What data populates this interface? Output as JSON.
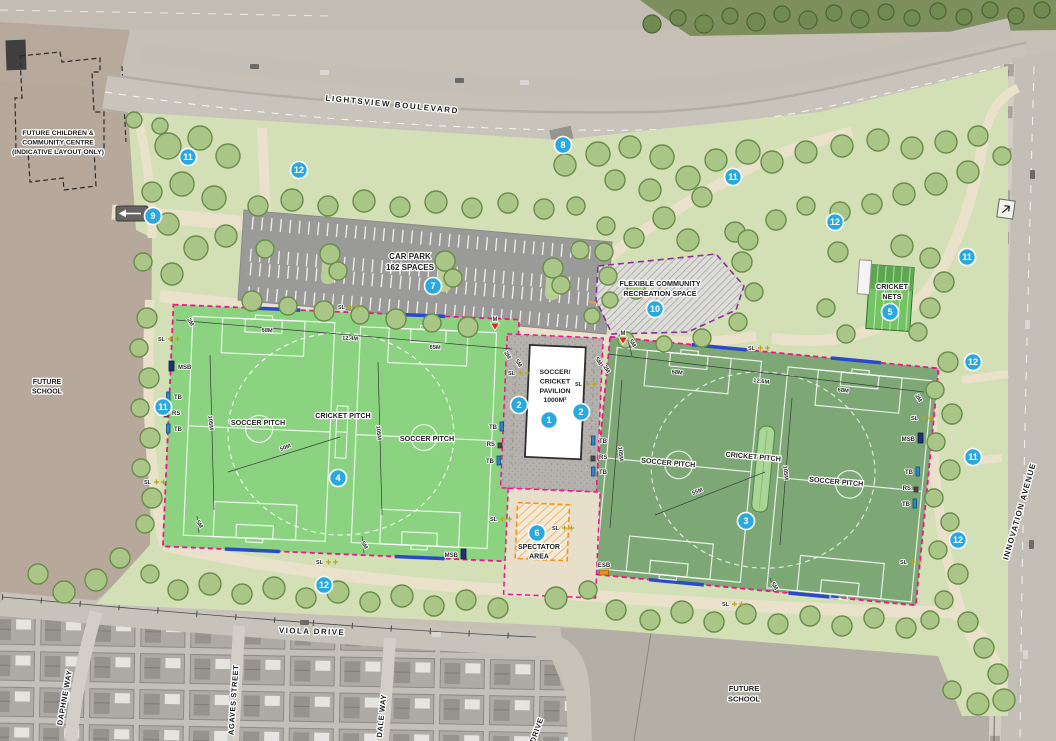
{
  "road_labels": [
    {
      "id": "lightsview-boulevard",
      "text": "LIGHTSVIEW BOULEVARD",
      "x": 392,
      "y": 107,
      "rot": 5.5,
      "size": 8,
      "ls": 1.6
    },
    {
      "id": "viola-drive",
      "text": "VIOLA DRIVE",
      "x": 312,
      "y": 634,
      "rot": 2,
      "size": 8,
      "ls": 1.4
    },
    {
      "id": "innovation-avenue",
      "text": "INNOVATION AVENUE",
      "x": 1022,
      "y": 512,
      "rot": -74,
      "size": 8,
      "ls": 1
    },
    {
      "id": "daphne-way",
      "text": "DAPHNE WAY",
      "x": 67,
      "y": 698,
      "rot": -80,
      "size": 7.5,
      "ls": 0.6
    },
    {
      "id": "agaves-street",
      "text": "AGAVES STREET",
      "x": 236,
      "y": 700,
      "rot": -86,
      "size": 7.5,
      "ls": 0.6
    },
    {
      "id": "dale-way",
      "text": "DALE WAY",
      "x": 384,
      "y": 716,
      "rot": -84,
      "size": 7.5,
      "ls": 0.6
    },
    {
      "id": "drive",
      "text": "DRIVE",
      "x": 539,
      "y": 731,
      "rot": -70,
      "size": 7.5,
      "ls": 0.6
    }
  ],
  "area_labels": [
    {
      "id": "future-children-community-centre",
      "lines": [
        "FUTURE CHILDREN &",
        "COMMUNITY CENTRE",
        "(INDICATIVE LAYOUT ONLY)"
      ],
      "x": 58,
      "y": 135,
      "size": 6.8
    },
    {
      "id": "future-school-west",
      "lines": [
        "FUTURE",
        "SCHOOL"
      ],
      "x": 47,
      "y": 384,
      "size": 7
    },
    {
      "id": "future-school-south",
      "lines": [
        "FUTURE",
        "SCHOOL"
      ],
      "x": 744,
      "y": 691,
      "size": 7.5
    },
    {
      "id": "car-park",
      "lines": [
        "CAR PARK",
        "162 SPACES"
      ],
      "x": 410,
      "y": 259,
      "size": 8
    },
    {
      "id": "flexible-community-recreation-space",
      "lines": [
        "FLEXIBLE COMMUNITY",
        "RECREATION SPACE"
      ],
      "x": 660,
      "y": 286,
      "size": 7.2
    },
    {
      "id": "cricket-nets",
      "lines": [
        "CRICKET",
        "NETS"
      ],
      "x": 892,
      "y": 289,
      "size": 7.2
    },
    {
      "id": "soccer-pitch-west-1",
      "lines": [
        "SOCCER PITCH"
      ],
      "x": 258,
      "y": 425,
      "size": 7.2
    },
    {
      "id": "cricket-pitch-west",
      "lines": [
        "CRICKET PITCH"
      ],
      "x": 343,
      "y": 418,
      "size": 7.2
    },
    {
      "id": "soccer-pitch-west-2",
      "lines": [
        "SOCCER PITCH"
      ],
      "x": 427,
      "y": 441,
      "size": 7.2
    },
    {
      "id": "soccer-pitch-east-1",
      "lines": [
        "SOCCER PITCH"
      ],
      "x": 668,
      "y": 465,
      "size": 7.2,
      "rot": 5
    },
    {
      "id": "cricket-pitch-east",
      "lines": [
        "CRICKET PITCH"
      ],
      "x": 753,
      "y": 459,
      "size": 7.2,
      "rot": 5
    },
    {
      "id": "soccer-pitch-east-2",
      "lines": [
        "SOCCER PITCH"
      ],
      "x": 836,
      "y": 484,
      "size": 7.2,
      "rot": 5
    },
    {
      "id": "pavilion",
      "lines": [
        "SOCCER/",
        "CRICKET",
        "PAVILION",
        "1000M²"
      ],
      "x": 555,
      "y": 374,
      "size": 6.8
    },
    {
      "id": "spectator-area",
      "lines": [
        "SPECTATOR",
        "AREA"
      ],
      "x": 539,
      "y": 549,
      "size": 7
    }
  ],
  "markers": [
    {
      "n": "1",
      "x": 549,
      "y": 420
    },
    {
      "n": "2",
      "x": 519,
      "y": 405
    },
    {
      "n": "2",
      "x": 581,
      "y": 412
    },
    {
      "n": "3",
      "x": 746,
      "y": 521
    },
    {
      "n": "4",
      "x": 338,
      "y": 478
    },
    {
      "n": "5",
      "x": 890,
      "y": 312
    },
    {
      "n": "6",
      "x": 537,
      "y": 533
    },
    {
      "n": "7",
      "x": 433,
      "y": 286
    },
    {
      "n": "8",
      "x": 563,
      "y": 145
    },
    {
      "n": "9",
      "x": 153,
      "y": 216
    },
    {
      "n": "10",
      "x": 655,
      "y": 309
    },
    {
      "n": "11",
      "x": 188,
      "y": 157
    },
    {
      "n": "11",
      "x": 733,
      "y": 177
    },
    {
      "n": "11",
      "x": 967,
      "y": 257
    },
    {
      "n": "11",
      "x": 163,
      "y": 407
    },
    {
      "n": "11",
      "x": 973,
      "y": 457
    },
    {
      "n": "12",
      "x": 299,
      "y": 170
    },
    {
      "n": "12",
      "x": 835,
      "y": 222
    },
    {
      "n": "12",
      "x": 973,
      "y": 362
    },
    {
      "n": "12",
      "x": 958,
      "y": 540
    },
    {
      "n": "12",
      "x": 324,
      "y": 585
    }
  ],
  "dimensions": [
    {
      "text": "2M",
      "x": 189,
      "y": 323,
      "rot": 60
    },
    {
      "text": "68M",
      "x": 267,
      "y": 332,
      "rot": 4
    },
    {
      "text": "12.4M",
      "x": 350,
      "y": 340,
      "rot": 4
    },
    {
      "text": "65M",
      "x": 435,
      "y": 349,
      "rot": 4
    },
    {
      "text": "2M",
      "x": 506,
      "y": 356,
      "rot": 60
    },
    {
      "text": "105M",
      "x": 209,
      "y": 423,
      "rot": 85
    },
    {
      "text": "105M",
      "x": 377,
      "y": 433,
      "rot": 85
    },
    {
      "text": "50M",
      "x": 286,
      "y": 449,
      "rot": -22
    },
    {
      "text": "5M",
      "x": 198,
      "y": 525,
      "rot": 60
    },
    {
      "text": "5M",
      "x": 363,
      "y": 546,
      "rot": 60
    },
    {
      "text": "5M",
      "x": 517,
      "y": 364,
      "rot": 60
    },
    {
      "text": "5M",
      "x": 597,
      "y": 362,
      "rot": 60
    },
    {
      "text": "5M",
      "x": 631,
      "y": 344,
      "rot": 60
    },
    {
      "text": "2M",
      "x": 605,
      "y": 370,
      "rot": 60
    },
    {
      "text": "68M",
      "x": 677,
      "y": 374,
      "rot": 7
    },
    {
      "text": "12.6M",
      "x": 761,
      "y": 383,
      "rot": 7
    },
    {
      "text": "68M",
      "x": 843,
      "y": 392,
      "rot": 7
    },
    {
      "text": "2M",
      "x": 917,
      "y": 399,
      "rot": 60
    },
    {
      "text": "105M",
      "x": 619,
      "y": 454,
      "rot": 85
    },
    {
      "text": "105M",
      "x": 784,
      "y": 473,
      "rot": 85
    },
    {
      "text": "55M",
      "x": 698,
      "y": 493,
      "rot": -22
    },
    {
      "text": "5M",
      "x": 773,
      "y": 587,
      "rot": 60
    }
  ],
  "equipment": [
    {
      "t": "MSB",
      "x": 178,
      "y": 369,
      "s": "il"
    },
    {
      "t": "TB",
      "x": 174,
      "y": 399,
      "s": "il"
    },
    {
      "t": "RS",
      "x": 172,
      "y": 415,
      "s": "il"
    },
    {
      "t": "TB",
      "x": 174,
      "y": 431,
      "s": "il"
    },
    {
      "t": "TB",
      "x": 497,
      "y": 429,
      "s": "ir"
    },
    {
      "t": "RS",
      "x": 495,
      "y": 446,
      "s": "ir"
    },
    {
      "t": "TB",
      "x": 494,
      "y": 463,
      "s": "ir"
    },
    {
      "t": "TB",
      "x": 599,
      "y": 443,
      "s": "il"
    },
    {
      "t": "RS",
      "x": 599,
      "y": 459,
      "s": "il"
    },
    {
      "t": "TB",
      "x": 599,
      "y": 474,
      "s": "il"
    },
    {
      "t": "MSB",
      "x": 915,
      "y": 441,
      "s": "ir"
    },
    {
      "t": "TB",
      "x": 913,
      "y": 474,
      "s": "ir"
    },
    {
      "t": "RS",
      "x": 911,
      "y": 490,
      "s": "ir"
    },
    {
      "t": "TB",
      "x": 910,
      "y": 506,
      "s": "ir"
    },
    {
      "t": "MSB",
      "x": 458,
      "y": 557,
      "s": "ir"
    },
    {
      "t": "ESB",
      "x": 604,
      "y": 567,
      "s": "ib"
    }
  ],
  "light_label": "SL",
  "lights": [
    [
      352,
      307
    ],
    [
      172,
      339
    ],
    [
      158,
      482
    ],
    [
      330,
      562
    ],
    [
      504,
      519
    ],
    [
      566,
      528
    ],
    [
      736,
      604
    ],
    [
      914,
      562
    ],
    [
      762,
      348
    ],
    [
      522,
      373
    ],
    [
      589,
      384
    ],
    [
      925,
      418
    ]
  ],
  "monument_label": "M",
  "monuments": [
    {
      "x": 495,
      "y": 321
    },
    {
      "x": 623,
      "y": 335
    }
  ],
  "colors": {
    "marker_blue": "#2aa9e1",
    "boundary_pink": "#f0148c",
    "boundary_blue": "#2b49cc",
    "flexible_purple": "#8c2f96",
    "spectator_orange": "#f6921e",
    "field_west_green": "#8bd381",
    "field_east_green": "#7da875",
    "park_green": "#d3e0b6"
  },
  "decor": {
    "trees": [
      [
        168,
        146,
        13
      ],
      [
        200,
        138,
        12
      ],
      [
        228,
        156,
        12
      ],
      [
        182,
        184,
        12
      ],
      [
        214,
        198,
        12
      ],
      [
        168,
        224,
        11
      ],
      [
        196,
        248,
        12
      ],
      [
        172,
        274,
        11
      ],
      [
        226,
        236,
        11
      ],
      [
        152,
        192,
        10
      ],
      [
        143,
        262,
        9
      ],
      [
        258,
        206,
        10
      ],
      [
        292,
        200,
        11
      ],
      [
        328,
        206,
        10
      ],
      [
        364,
        201,
        11
      ],
      [
        400,
        207,
        10
      ],
      [
        436,
        202,
        11
      ],
      [
        472,
        208,
        10
      ],
      [
        508,
        203,
        10
      ],
      [
        544,
        209,
        10
      ],
      [
        576,
        206,
        9
      ],
      [
        265,
        249,
        9
      ],
      [
        330,
        254,
        10
      ],
      [
        338,
        271,
        9
      ],
      [
        445,
        261,
        10
      ],
      [
        453,
        278,
        9
      ],
      [
        553,
        268,
        10
      ],
      [
        561,
        285,
        9
      ],
      [
        608,
        276,
        9
      ],
      [
        252,
        301,
        10
      ],
      [
        288,
        306,
        9
      ],
      [
        324,
        311,
        10
      ],
      [
        360,
        315,
        9
      ],
      [
        396,
        319,
        10
      ],
      [
        432,
        323,
        9
      ],
      [
        468,
        327,
        10
      ],
      [
        147,
        318,
        10
      ],
      [
        139,
        348,
        9
      ],
      [
        149,
        378,
        10
      ],
      [
        140,
        408,
        9
      ],
      [
        150,
        438,
        10
      ],
      [
        141,
        468,
        9
      ],
      [
        152,
        498,
        10
      ],
      [
        145,
        524,
        9
      ],
      [
        565,
        165,
        11
      ],
      [
        598,
        154,
        12
      ],
      [
        630,
        147,
        11
      ],
      [
        662,
        157,
        12
      ],
      [
        615,
        180,
        10
      ],
      [
        650,
        190,
        11
      ],
      [
        688,
        178,
        12
      ],
      [
        716,
        160,
        11
      ],
      [
        748,
        152,
        12
      ],
      [
        702,
        197,
        10
      ],
      [
        664,
        218,
        11
      ],
      [
        634,
        238,
        10
      ],
      [
        688,
        240,
        11
      ],
      [
        580,
        250,
        9
      ],
      [
        606,
        226,
        9
      ],
      [
        735,
        232,
        10
      ],
      [
        772,
        162,
        11
      ],
      [
        806,
        152,
        11
      ],
      [
        842,
        146,
        11
      ],
      [
        878,
        140,
        11
      ],
      [
        912,
        148,
        11
      ],
      [
        946,
        142,
        11
      ],
      [
        978,
        136,
        10
      ],
      [
        1002,
        156,
        9
      ],
      [
        968,
        172,
        11
      ],
      [
        936,
        184,
        11
      ],
      [
        904,
        194,
        11
      ],
      [
        872,
        204,
        10
      ],
      [
        840,
        212,
        10
      ],
      [
        806,
        206,
        9
      ],
      [
        776,
        220,
        10
      ],
      [
        748,
        240,
        10
      ],
      [
        636,
        290,
        9
      ],
      [
        610,
        300,
        8
      ],
      [
        838,
        252,
        10
      ],
      [
        902,
        246,
        11
      ],
      [
        930,
        258,
        10
      ],
      [
        944,
        282,
        10
      ],
      [
        930,
        308,
        10
      ],
      [
        918,
        332,
        9
      ],
      [
        846,
        334,
        9
      ],
      [
        826,
        308,
        9
      ],
      [
        948,
        362,
        10
      ],
      [
        935,
        390,
        9
      ],
      [
        952,
        414,
        10
      ],
      [
        936,
        442,
        9
      ],
      [
        950,
        470,
        10
      ],
      [
        934,
        498,
        9
      ],
      [
        950,
        522,
        9
      ],
      [
        938,
        550,
        9
      ],
      [
        958,
        574,
        10
      ],
      [
        944,
        600,
        9
      ],
      [
        968,
        622,
        10
      ],
      [
        984,
        648,
        10
      ],
      [
        998,
        674,
        10
      ],
      [
        1004,
        700,
        11
      ],
      [
        978,
        704,
        11
      ],
      [
        952,
        690,
        9
      ],
      [
        120,
        558,
        10
      ],
      [
        96,
        580,
        11
      ],
      [
        64,
        592,
        11
      ],
      [
        38,
        574,
        10
      ],
      [
        150,
        574,
        9
      ],
      [
        178,
        590,
        10
      ],
      [
        210,
        584,
        11
      ],
      [
        242,
        594,
        10
      ],
      [
        274,
        588,
        11
      ],
      [
        306,
        598,
        10
      ],
      [
        338,
        592,
        11
      ],
      [
        370,
        602,
        10
      ],
      [
        402,
        596,
        11
      ],
      [
        434,
        606,
        10
      ],
      [
        466,
        600,
        10
      ],
      [
        498,
        608,
        10
      ],
      [
        556,
        598,
        11
      ],
      [
        588,
        590,
        9
      ],
      [
        616,
        610,
        10
      ],
      [
        650,
        620,
        10
      ],
      [
        682,
        612,
        11
      ],
      [
        714,
        622,
        10
      ],
      [
        746,
        614,
        10
      ],
      [
        778,
        624,
        10
      ],
      [
        810,
        616,
        10
      ],
      [
        842,
        626,
        10
      ],
      [
        874,
        618,
        10
      ],
      [
        906,
        628,
        10
      ],
      [
        930,
        620,
        9
      ],
      [
        604,
        252,
        9
      ],
      [
        742,
        262,
        10
      ],
      [
        754,
        292,
        9
      ],
      [
        738,
        322,
        9
      ],
      [
        702,
        338,
        9
      ],
      [
        664,
        344,
        8
      ],
      [
        626,
        340,
        8
      ],
      [
        592,
        316,
        8
      ],
      [
        160,
        126,
        8
      ],
      [
        134,
        120,
        8
      ]
    ],
    "bushes": [
      [
        652,
        24,
        9
      ],
      [
        678,
        18,
        8
      ],
      [
        704,
        24,
        9
      ],
      [
        730,
        16,
        8
      ],
      [
        756,
        22,
        9
      ],
      [
        782,
        14,
        8
      ],
      [
        808,
        20,
        9
      ],
      [
        834,
        13,
        8
      ],
      [
        860,
        19,
        9
      ],
      [
        886,
        12,
        8
      ],
      [
        912,
        18,
        8
      ],
      [
        938,
        11,
        8
      ],
      [
        964,
        17,
        8
      ],
      [
        990,
        10,
        8
      ],
      [
        1016,
        16,
        8
      ],
      [
        1042,
        10,
        8
      ]
    ],
    "cars": [
      [
        1030,
        170,
        "v"
      ],
      [
        1025,
        320,
        "v"
      ],
      [
        1029,
        540,
        "v"
      ],
      [
        1023,
        650,
        "v"
      ],
      [
        300,
        620,
        "h"
      ],
      [
        432,
        632,
        "h"
      ],
      [
        250,
        64,
        "h"
      ],
      [
        320,
        70,
        "h"
      ],
      [
        455,
        78,
        "h"
      ],
      [
        520,
        80,
        "h"
      ]
    ]
  }
}
